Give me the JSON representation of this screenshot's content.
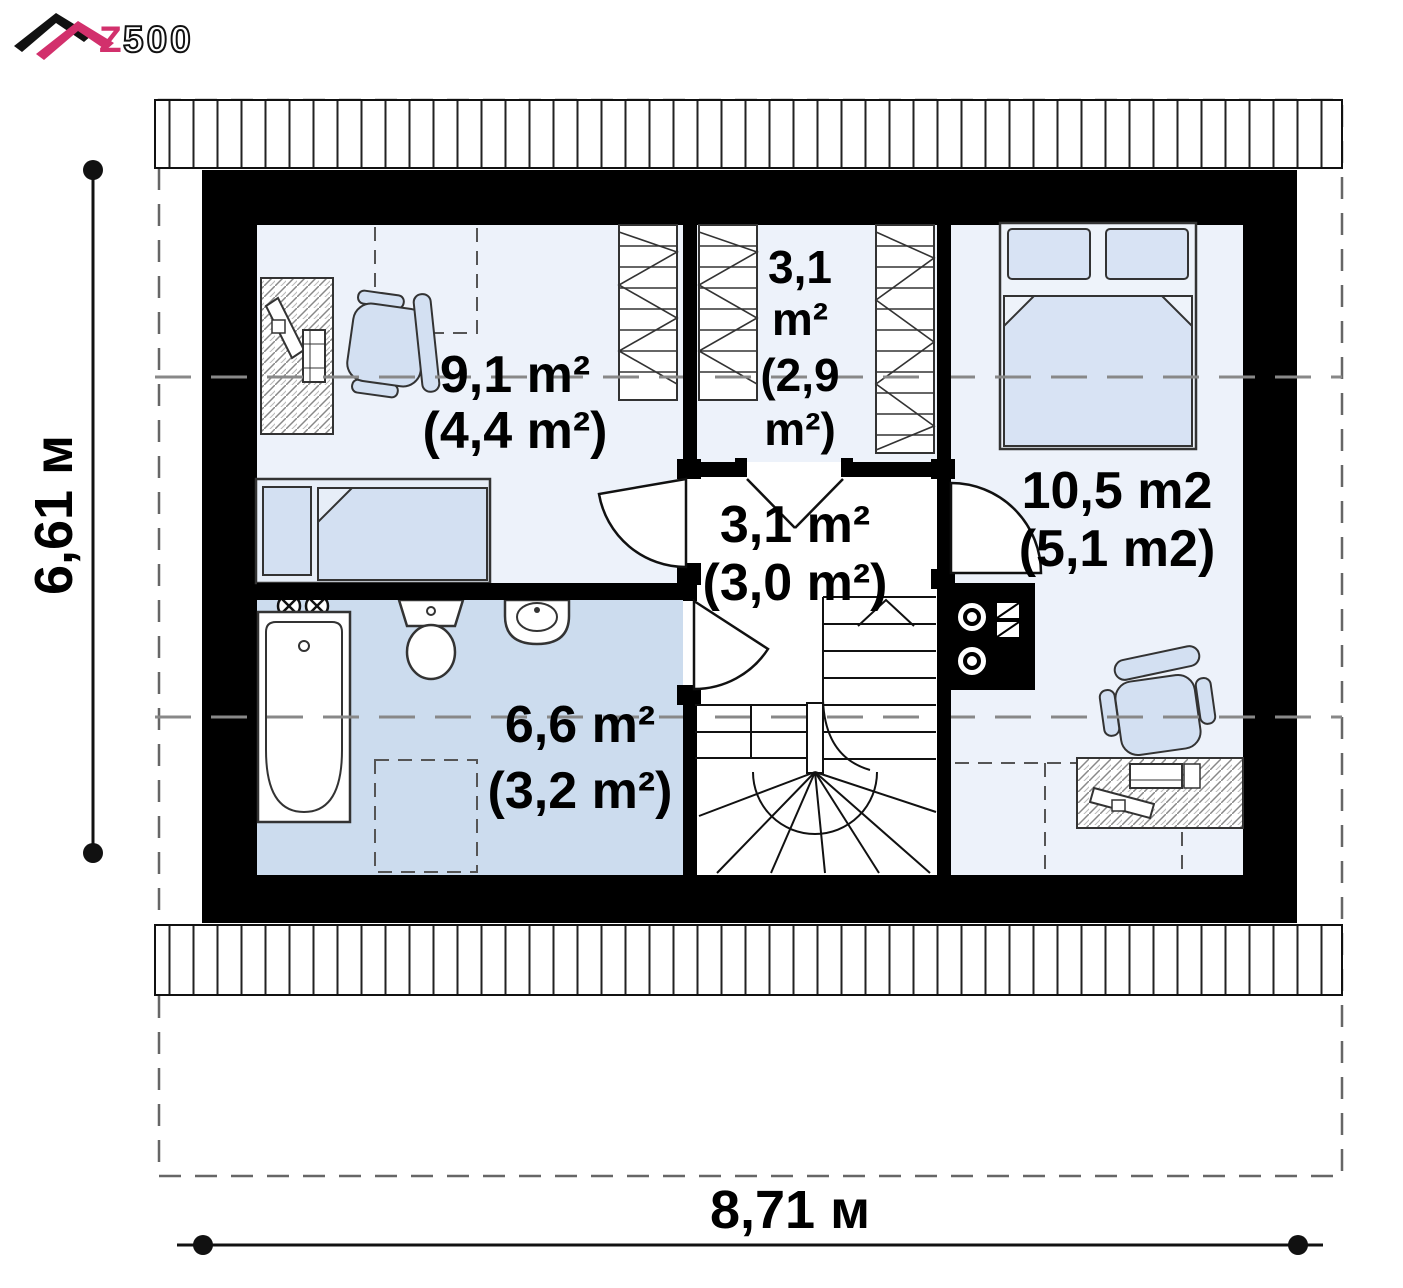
{
  "logo": {
    "z": "Z",
    "suffix": "500"
  },
  "dimensions": {
    "height": "6,61 м",
    "width": "8,71 м"
  },
  "rooms": {
    "child": {
      "area": "9,1 m²",
      "area_attic": "(4,4 m²)"
    },
    "wardrobe": {
      "line1": "3,1",
      "line2": "m²",
      "line3": "(2,9",
      "line4": "m²)"
    },
    "hall": {
      "area": "3,1 m²",
      "area_attic": "(3,0 m²)"
    },
    "bedroom": {
      "area": "10,5 m2",
      "area_attic": "(5,1 m2)"
    },
    "bathroom": {
      "area": "6,6 m²",
      "area_attic": "(3,2 m²)"
    }
  },
  "colors": {
    "accent_pink": "#d2306c",
    "wall": "#000000",
    "room_floor": "#edf2fa",
    "bathroom_floor": "#ccdcee",
    "furniture_fill": "#d3e0f2",
    "dashed_line": "#888888"
  }
}
